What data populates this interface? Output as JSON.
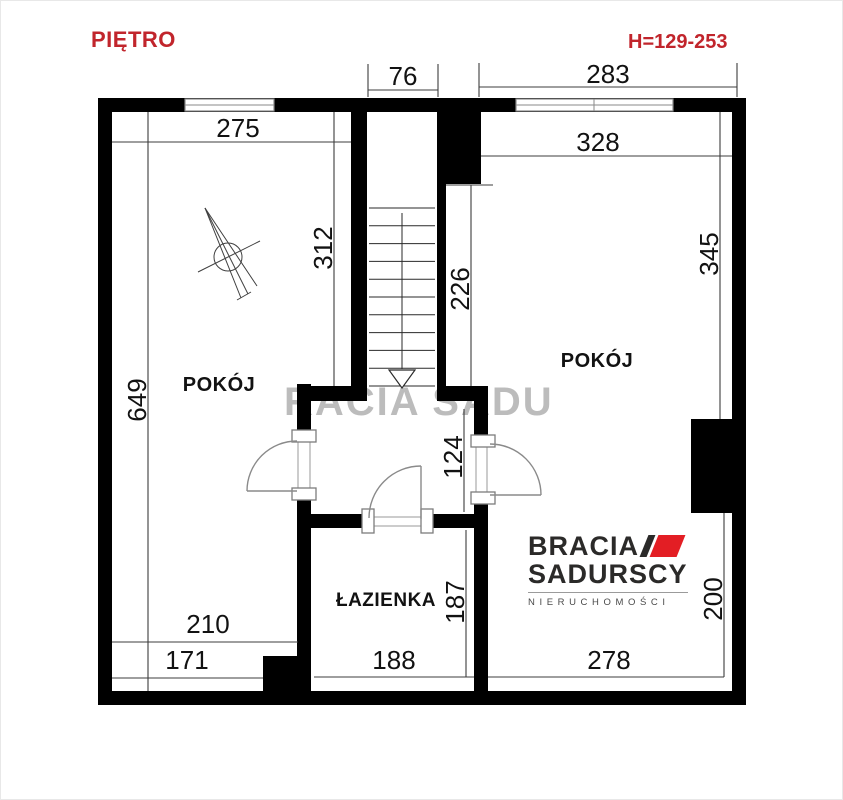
{
  "header": {
    "title": "PIĘTRO",
    "height_note": "H=129-253"
  },
  "rooms": {
    "left_room": "POKÓJ",
    "right_room": "POKÓJ",
    "bathroom": "ŁAZIENKA"
  },
  "dims": {
    "stairwell_top_width": "76",
    "right_top_width": "283",
    "left_room_width": "275",
    "right_room_width": "328",
    "left_room_height": "312",
    "stair_side_height": "226",
    "right_room_height": "345",
    "left_wall_height": "649",
    "hall_height": "124",
    "bottom_left_upper": "210",
    "bottom_left_lower": "171",
    "bathroom_width": "188",
    "bathroom_height": "187",
    "right_room_bottom_width": "278",
    "right_room_lower_height": "200"
  },
  "watermark": {
    "text": "RACIA SADU"
  },
  "logo": {
    "brand_top": "BRACIA",
    "brand_bottom": "SADURSCY",
    "tagline": "NIERUCHOMOŚCI"
  },
  "stairs": {
    "tread_count": 11,
    "direction": "down"
  },
  "colors": {
    "accent_red": "#c1252c",
    "logo_red": "#e31e24",
    "logo_dark": "#2b2a29",
    "wall_black": "#000000"
  }
}
